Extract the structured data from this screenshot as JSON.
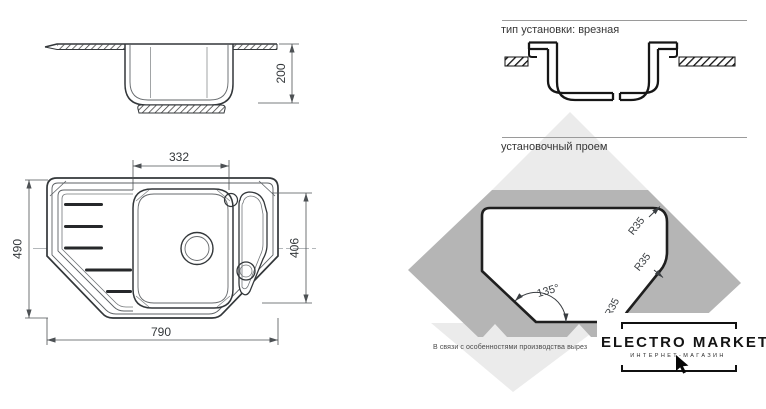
{
  "left_drawing": {
    "side_view_depth": "200",
    "bowl_width": "332",
    "overall_depth": "490",
    "bowl_zone_depth": "406",
    "overall_width": "790"
  },
  "right_panel": {
    "install_type_header": "тип установки: врезная",
    "opening_header": "установочный проем",
    "radius_label_1": "R35",
    "radius_label_2": "R35",
    "radius_label_3": "R35",
    "angle_label": "135°",
    "production_note": "В связи с особенностями производства вырез",
    "logo": {
      "title": "ELECTRO MARKET",
      "subtitle": "ИНТЕРНЕТ-МАГАЗИН"
    }
  },
  "colors": {
    "drawing_line": "#33373a",
    "dim_line": "#4d5154",
    "gray_dark": "#b5b5b5",
    "gray_light": "#ebebeb",
    "rule_line": "#9a9a9a",
    "logo_ink": "#141414",
    "background": "#ffffff"
  }
}
